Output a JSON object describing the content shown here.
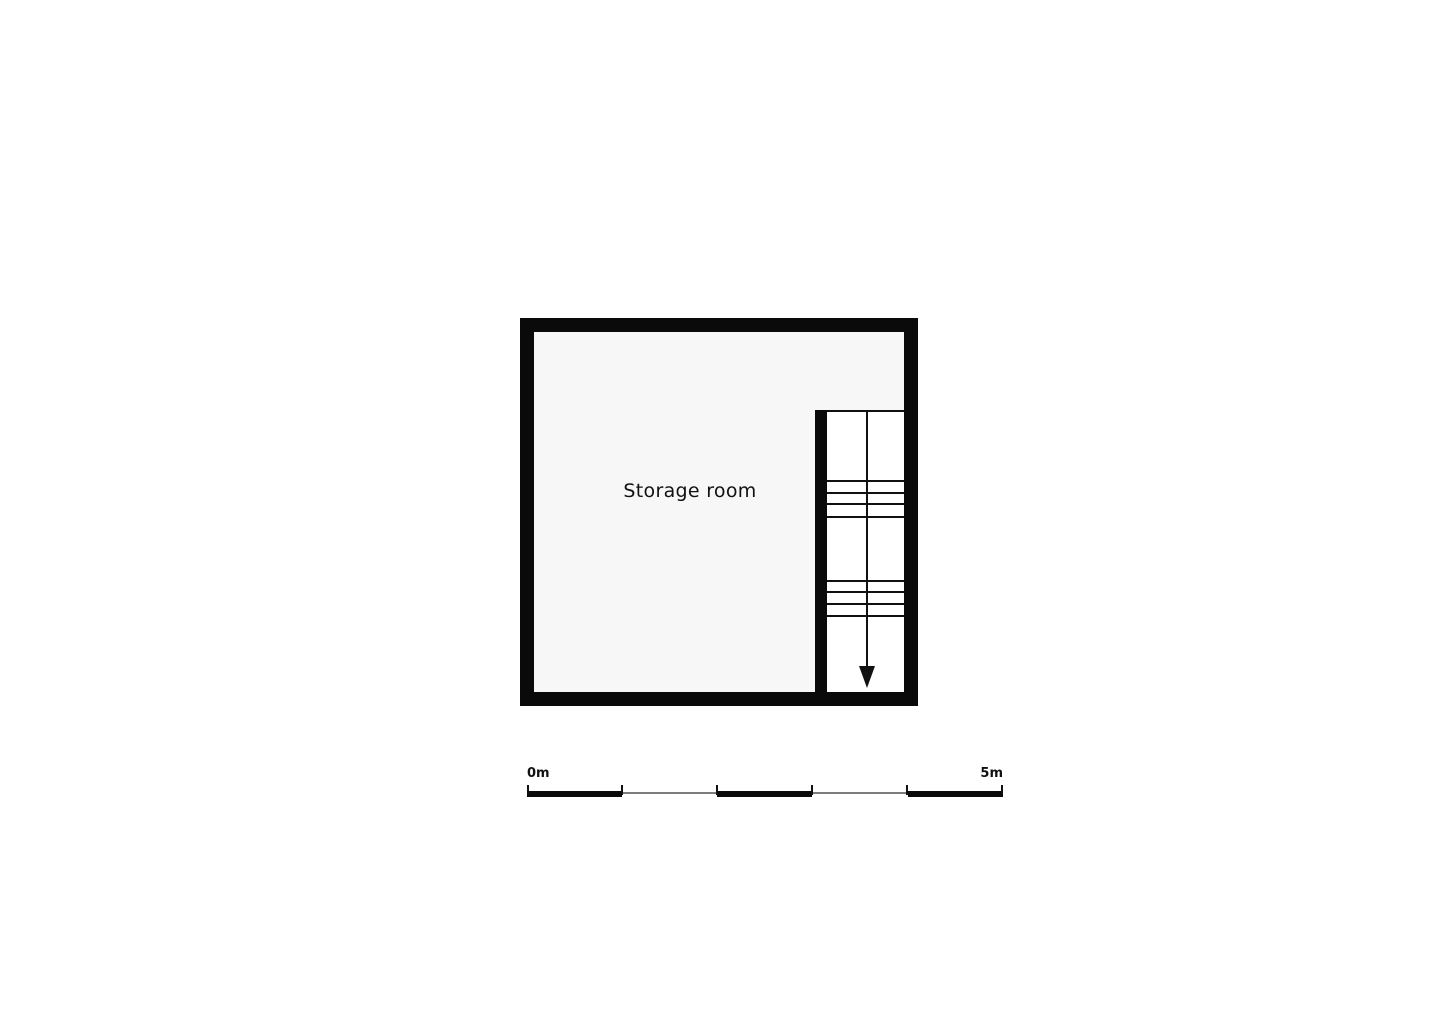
{
  "floorplan": {
    "room_label": "Storage room",
    "stair": {
      "direction_arrow": "down",
      "flights": 2,
      "tread_groups": [
        4,
        4
      ]
    },
    "scale_bar": {
      "start_label": "0m",
      "end_label": "5m",
      "total_meters": 5,
      "segment_count": 5
    },
    "colors": {
      "wall": "#0a0a0a",
      "room_fill": "#f7f7f7",
      "stair_fill": "#ffffff",
      "line": "#111111",
      "scale_thin_line": "#7d7d7d",
      "background": "#ffffff",
      "text": "#111111"
    }
  }
}
